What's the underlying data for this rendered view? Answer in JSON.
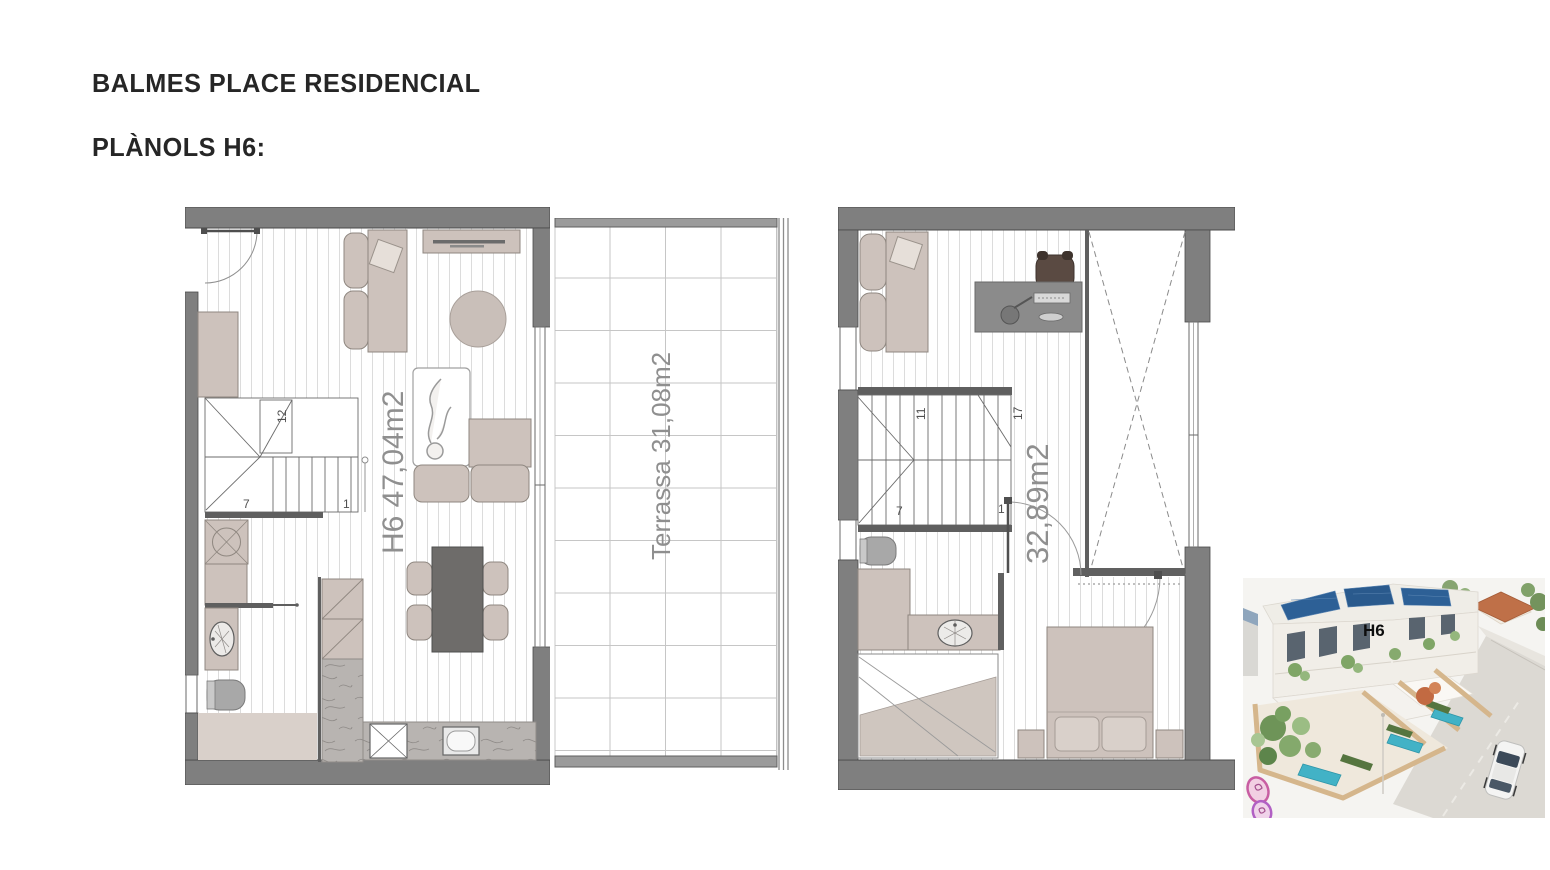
{
  "page": {
    "title": "BALMES PLACE RESIDENCIAL",
    "subtitle": "PLÀNOLS H6:"
  },
  "plans": {
    "ground_floor": {
      "area_label": "H6 47,04m2",
      "stair_numbers": {
        "top": "12",
        "bottom_left": "7",
        "bottom_right": "1"
      }
    },
    "terrace": {
      "area_label": "Terrassa 31,08m2"
    },
    "upper_floor": {
      "area_label": "32,89m2",
      "stair_numbers": {
        "top_left": "11",
        "top_right": "17",
        "bottom_left": "7",
        "bottom_right": "1"
      }
    }
  },
  "render_photo": {
    "unit_label": "H6"
  },
  "colors": {
    "wall": "#7f7f7f",
    "wall_dark": "#5f5f5f",
    "furniture": "#cdc2bc",
    "floor_stripe": "#dcdcdc",
    "marble": "#b8b4b1",
    "table": "#6e6c6a",
    "area_text": "#8f8f8f",
    "title_text": "#262626",
    "solar_panel": "#2d6096",
    "pool": "#42b2c6",
    "fence": "#d5b68c",
    "roof_neighbor": "#bf7048",
    "logo_pink": "#c85da2"
  }
}
